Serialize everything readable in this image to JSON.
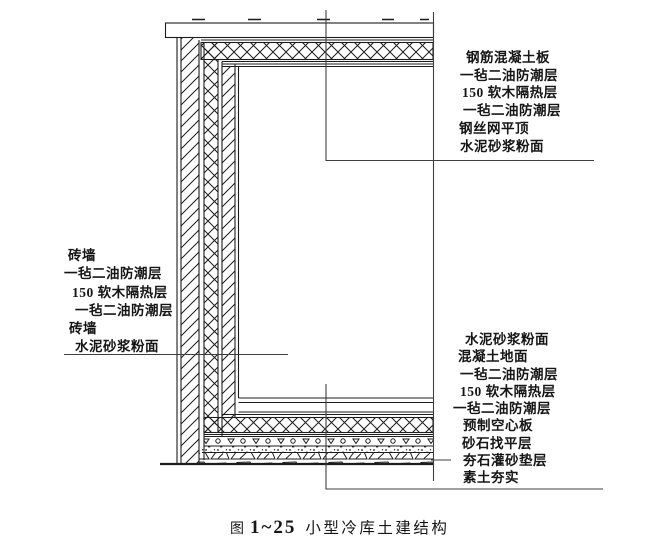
{
  "figure": {
    "kind": "construction-section-diagram",
    "caption": {
      "prefix": "图",
      "number": "1~25",
      "title": "小型冷库土建结构"
    },
    "label_groups": {
      "wall": [
        "砖墙",
        "一毡二油防潮层",
        "150 软木隔热层",
        "一毡二油防潮层",
        "砖墙",
        "水泥砂浆粉面"
      ],
      "ceiling": [
        "钢筋混凝土板",
        "一毡二油防潮层",
        "150 软木隔热层",
        "一毡二油防潮层",
        "钢丝网平顶",
        "水泥砂浆粉面"
      ],
      "floor": [
        "水泥砂浆粉面",
        "混凝土地面",
        "一毡二油防潮层",
        "150 软木隔热层",
        "一毡二油防潮层",
        "预制空心板",
        "砂石找平层",
        "夯石灌砂垫层",
        "素土夯实"
      ]
    },
    "colors": {
      "ink": "#1c1c1c",
      "leader": "#3f3f3f",
      "background": "#ffffff"
    }
  }
}
